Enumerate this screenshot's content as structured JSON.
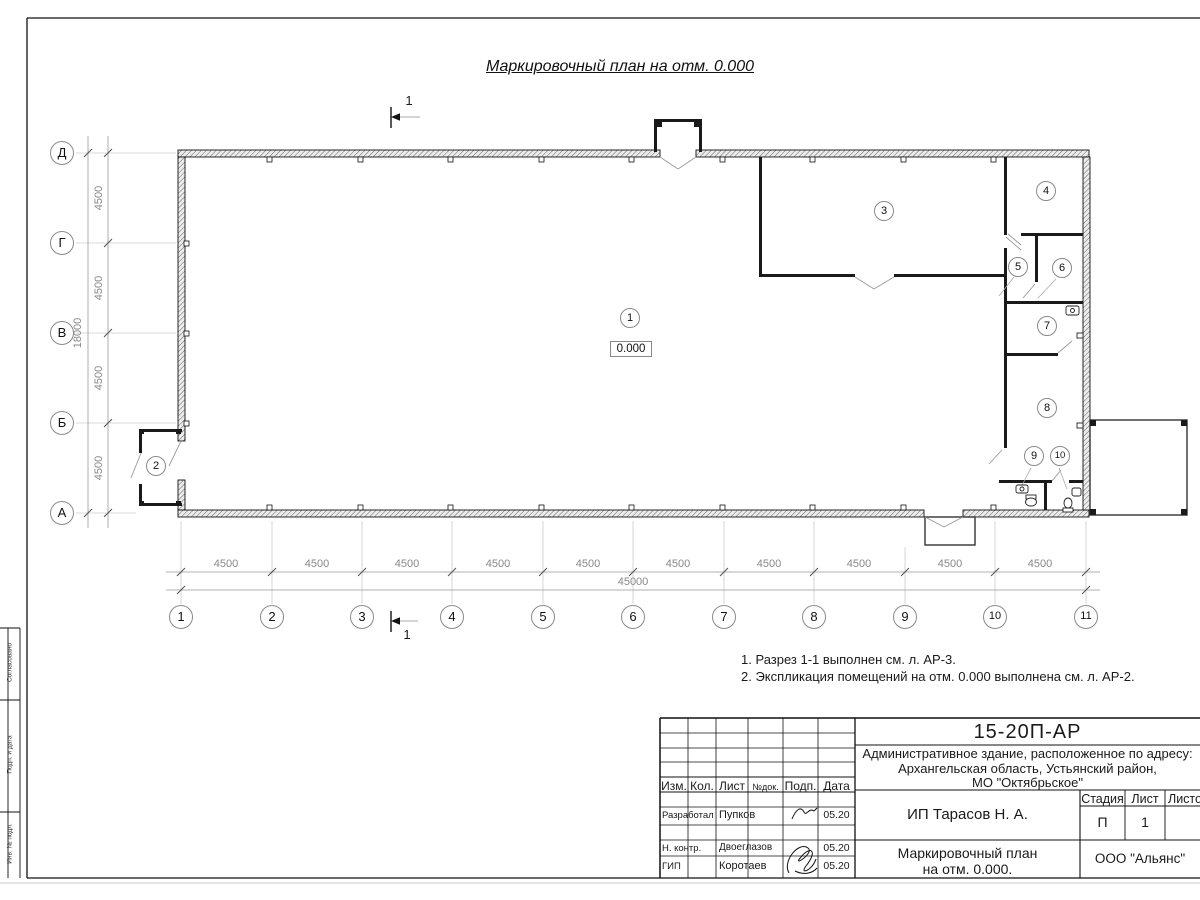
{
  "sheet": {
    "title": "Маркировочный план на отм. 0.000",
    "section_label": "1",
    "notes": {
      "line1": "1. Разрез 1-1 выполнен см. л. АР-3.",
      "line2": "2. Экспликация помещений на отм. 0.000 выполнена см. л. АР-2."
    }
  },
  "axes": {
    "h": [
      "1",
      "2",
      "3",
      "4",
      "5",
      "6",
      "7",
      "8",
      "9",
      "10",
      "11"
    ],
    "v": [
      "Д",
      "Г",
      "В",
      "Б",
      "А"
    ]
  },
  "dims": {
    "bay": "4500",
    "total_width": "45000",
    "total_height": "18000"
  },
  "rooms": {
    "r1": "1",
    "r2": "2",
    "r3": "3",
    "r4": "4",
    "r5": "5",
    "r6": "6",
    "r7": "7",
    "r8": "8",
    "r9": "9",
    "r10": "10",
    "elevation": "0.000"
  },
  "frame": {
    "col1": "Согласовано",
    "col2": "Подп. и дата",
    "col3": "Инв. № подл."
  },
  "titleblock": {
    "doc_number": "15-20П-АР",
    "project_line1": "Административное здание, расположенное по адресу:",
    "project_line2": "Архангельская область, Устьянский район,",
    "project_line3": "МО \"Октябрьское\"",
    "client": "ИП Тарасов Н. А.",
    "sheet_name_line1": "Маркировочный план",
    "sheet_name_line2": "на отм. 0.000.",
    "org": "ООО \"Альянс\"",
    "stage_label": "Стадия",
    "sheet_label": "Лист",
    "sheets_label": "Листов",
    "stage": "П",
    "sheet_no": "1",
    "cols": {
      "c1": "Изм.",
      "c2": "Кол.",
      "c3": "Лист",
      "c4": "№док.",
      "c5": "Подп.",
      "c6": "Дата"
    },
    "rows": {
      "r1_role": "Разработал",
      "r1_name": "Пупков",
      "r1_date": "05.20",
      "r2_role": "Н. контр.",
      "r2_name": "Двоеглазов",
      "r2_date": "05.20",
      "r3_role": "ГИП",
      "r3_name": "Коротаев",
      "r3_date": "05.20"
    }
  }
}
